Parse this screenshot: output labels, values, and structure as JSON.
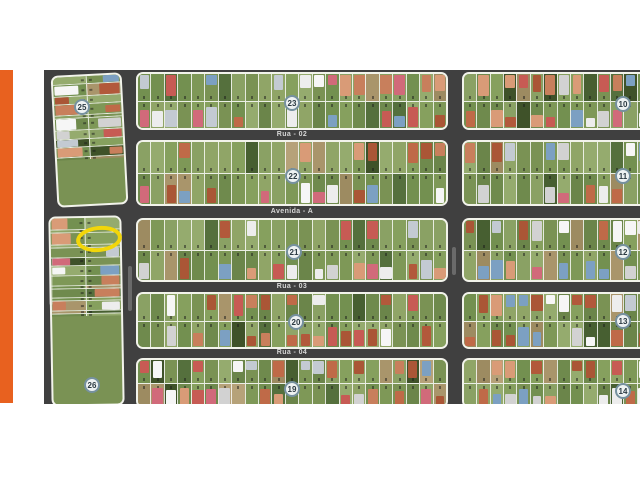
{
  "page": {
    "background_color": "#ffffff",
    "accent_bar_color": "#e8611f"
  },
  "map": {
    "type": "aerial-subdivision-plan",
    "road_color": "#404040",
    "highlight_color": "#f2d60a",
    "streets": [
      {
        "label": "Rua - 02"
      },
      {
        "label": "Avenida - A"
      },
      {
        "label": "Rua - 03"
      },
      {
        "label": "Rua - 04"
      }
    ],
    "blocks": [
      {
        "label": "25"
      },
      {
        "label": "23"
      },
      {
        "label": "10"
      },
      {
        "label": "22"
      },
      {
        "label": "11"
      },
      {
        "label": "21"
      },
      {
        "label": "12"
      },
      {
        "label": "20"
      },
      {
        "label": "13"
      },
      {
        "label": "19"
      },
      {
        "label": "14"
      },
      {
        "label": "26"
      }
    ]
  }
}
